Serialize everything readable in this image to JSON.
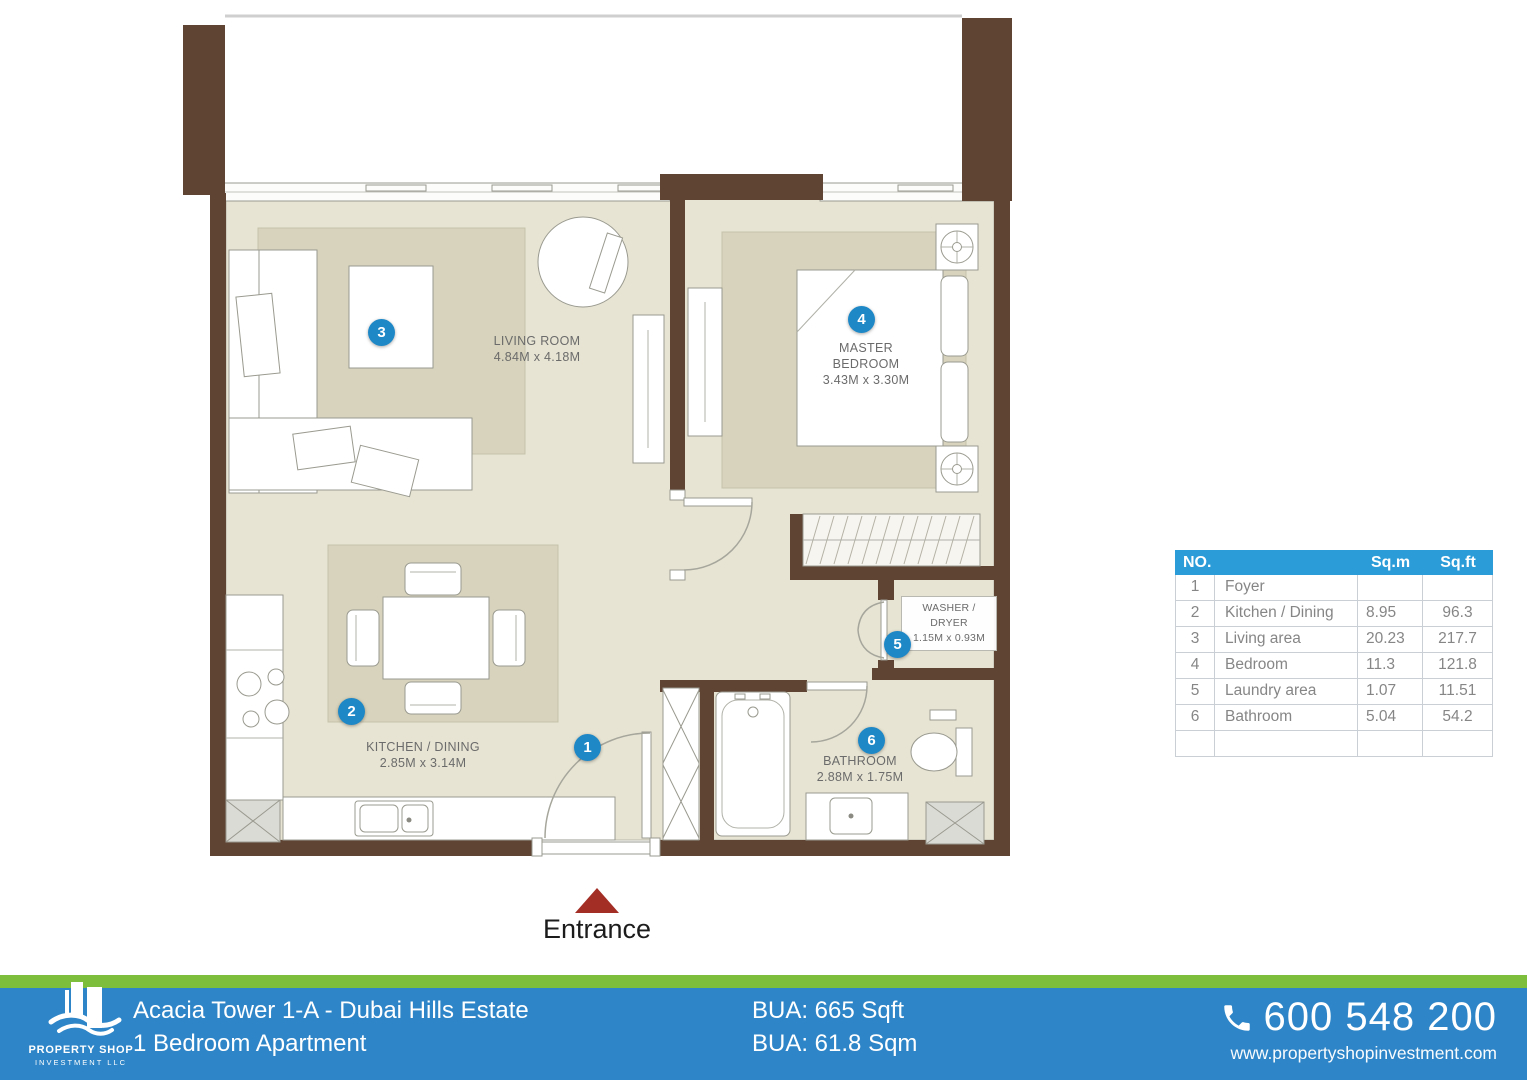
{
  "plan": {
    "entrance_label": "Entrance",
    "rooms": {
      "foyer": {
        "marker": "1"
      },
      "kitchen": {
        "marker": "2",
        "name": "KITCHEN / DINING",
        "dims": "2.85M x 3.14M"
      },
      "living": {
        "marker": "3",
        "name": "LIVING ROOM",
        "dims": "4.84M x 4.18M"
      },
      "bedroom": {
        "marker": "4",
        "name_line1": "MASTER",
        "name_line2": "BEDROOM",
        "dims": "3.43M x 3.30M"
      },
      "washer": {
        "marker": "5",
        "name_line1": "WASHER /",
        "name_line2": "DRYER",
        "dims": "1.15M x 0.93M"
      },
      "bathroom": {
        "marker": "6",
        "name": "BATHROOM",
        "dims": "2.88M x 1.75M"
      }
    }
  },
  "table": {
    "headers": {
      "no": "NO.",
      "sqm": "Sq.m",
      "sqft": "Sq.ft"
    },
    "rows": [
      {
        "no": "1",
        "name": "Foyer",
        "sqm": "",
        "sqft": ""
      },
      {
        "no": "2",
        "name": "Kitchen / Dining",
        "sqm": "8.95",
        "sqft": "96.3"
      },
      {
        "no": "3",
        "name": "Living area",
        "sqm": "20.23",
        "sqft": "217.7"
      },
      {
        "no": "4",
        "name": "Bedroom",
        "sqm": "11.3",
        "sqft": "121.8"
      },
      {
        "no": "5",
        "name": "Laundry area",
        "sqm": "1.07",
        "sqft": "11.51"
      },
      {
        "no": "6",
        "name": "Bathroom",
        "sqm": "5.04",
        "sqft": "54.2"
      },
      {
        "no": "",
        "name": "",
        "sqm": "",
        "sqft": ""
      }
    ]
  },
  "footer": {
    "logo_line1": "PROPERTY SHOP",
    "logo_line2": "INVESTMENT LLC",
    "title_line1": "Acacia Tower 1-A - Dubai Hills Estate",
    "title_line2": "1 Bedroom Apartment",
    "bua_line1": "BUA: 665 Sqft",
    "bua_line2": "BUA: 61.8 Sqm",
    "phone": "600 548 200",
    "website": "www.propertyshopinvestment.com"
  },
  "colors": {
    "footer_blue": "#2E85C7",
    "footer_green": "#7DBF3C",
    "table_header_blue": "#2B9CD8",
    "marker_blue": "#1E88C7",
    "wall_brown": "#5F4434",
    "entrance_red": "#A32E26"
  }
}
